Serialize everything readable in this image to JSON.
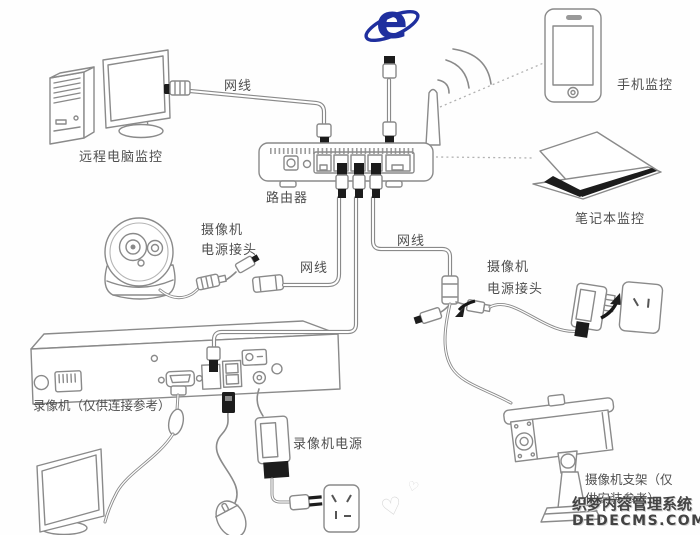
{
  "diagram": {
    "labels": {
      "remote_pc": "远程电脑监控",
      "network_cable": "网线",
      "router": "路由器",
      "phone_monitor": "手机监控",
      "laptop_monitor": "笔记本监控",
      "camera_power_line1": "摄像机",
      "camera_power_line2": "电源接头",
      "dvr": "录像机（仅供连接参考）",
      "dvr_power": "录像机电源",
      "camera_bracket_line1": "摄像机支架（仅",
      "camera_bracket_line2": "供安装参考）",
      "ie_letter": "e"
    },
    "watermark": {
      "line1": "织梦内容管理系统",
      "line2": "DEDECMS.COM"
    },
    "icons": {
      "heart": "♡"
    },
    "colors": {
      "ie_blue": "#1f2f9e",
      "line_gray": "#8a8a8a",
      "label_gray": "#4f4f4f",
      "watermark_gray": "#434343"
    }
  }
}
